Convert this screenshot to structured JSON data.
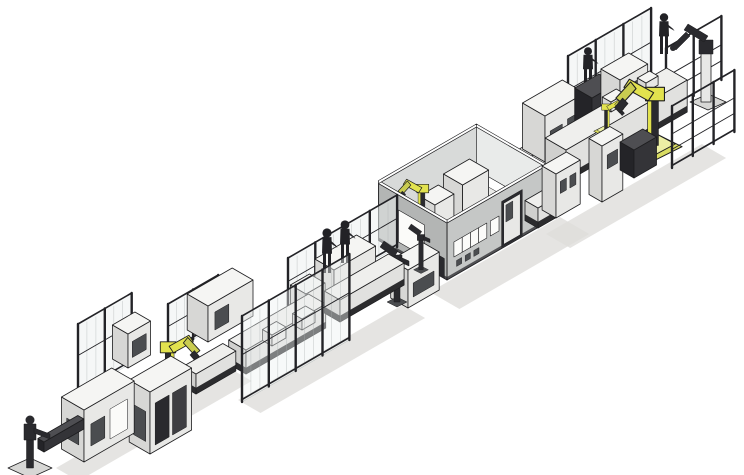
{
  "scene": {
    "alt": "Isometric CAD rendering of an automated assembly production line running diagonally from lower-left to upper-right, with safety fences, yellow industrial robots, operator figures, conveyors, machine cabinets and a central gray process enclosure",
    "width": 744,
    "height": 475,
    "components": [
      {
        "n": "ground-shadow-infeed",
        "t": "shadow",
        "o": [
          56,
          468
        ],
        "l": 200,
        "wd": 26
      },
      {
        "n": "ground-shadow-mid",
        "t": "shadow",
        "o": [
          238,
          400
        ],
        "l": 190,
        "wd": 26
      },
      {
        "n": "ground-shadow-enclosure",
        "t": "shadow",
        "o": [
          430,
          292
        ],
        "l": 150,
        "wd": 34
      },
      {
        "n": "ground-shadow-upper",
        "t": "shadow",
        "o": [
          546,
          234
        ],
        "l": 180,
        "wd": 28
      },
      {
        "n": "rear-storage-frame",
        "t": "frame",
        "o": [
          666,
          112
        ],
        "len": 64,
        "h": 64,
        "posts": 3
      },
      {
        "n": "rear-safety-fence-upper",
        "t": "fence",
        "o": [
          568,
          132
        ],
        "len": 96,
        "h": 76,
        "posts": 4
      },
      {
        "n": "operator-upper-line",
        "t": "worker",
        "o": [
          588,
          86
        ],
        "h": 40
      },
      {
        "n": "cabinet-upper-c",
        "t": "box",
        "o": [
          528,
          188
        ],
        "l": 20,
        "wd": 14,
        "h": 30,
        "c": "white"
      },
      {
        "n": "cabinet-upper-a",
        "t": "box",
        "o": [
          545,
          162
        ],
        "l": 46,
        "wd": 26,
        "h": 46,
        "c": "white",
        "panels": [
          [
            6,
            20,
            10,
            28,
            "md"
          ],
          [
            26,
            40,
            12,
            30,
            "md"
          ]
        ]
      },
      {
        "n": "cabinet-upper-dark",
        "t": "box",
        "o": [
          592,
          138
        ],
        "l": 28,
        "wd": 20,
        "h": 40,
        "c": "dark"
      },
      {
        "n": "cabinet-upper-b",
        "t": "box",
        "o": [
          620,
          124
        ],
        "l": 32,
        "wd": 22,
        "h": 44,
        "c": "white",
        "panels": [
          [
            6,
            26,
            12,
            34,
            "md"
          ]
        ]
      },
      {
        "n": "transfer-conveyor-upper",
        "t": "conv",
        "o": [
          566,
          182
        ],
        "len": 140,
        "wd": 24,
        "h": 32
      },
      {
        "n": "pallet-upper-1",
        "t": "box",
        "o": [
          611,
          112
        ],
        "l": 16,
        "wd": 10,
        "h": 10,
        "c": "white"
      },
      {
        "n": "pallet-upper-2",
        "t": "box",
        "o": [
          646,
          92
        ],
        "l": 14,
        "wd": 10,
        "h": 9,
        "c": "white"
      },
      {
        "n": "handling-robot-yellow-small",
        "t": "yrobot",
        "o": [
          606,
          130
        ],
        "s": 0.62,
        "flip": false
      },
      {
        "n": "gantry-robot-upper",
        "t": "yrobot",
        "o": [
          655,
          144
        ],
        "s": 1.35,
        "flip": true
      },
      {
        "n": "operator-upper-right",
        "t": "worker",
        "o": [
          664,
          54
        ],
        "h": 42
      },
      {
        "n": "pedestal-robot-end",
        "t": "drobot",
        "o": [
          706,
          100
        ],
        "v": "end"
      },
      {
        "n": "process-enclosure",
        "t": "room",
        "o": [
          447,
          280
        ],
        "l": 113,
        "wd": 79,
        "h": 57
      },
      {
        "n": "link-conveyor-room-exit",
        "t": "conv",
        "o": [
          538,
          228
        ],
        "len": 30,
        "wd": 15,
        "h": 20
      },
      {
        "n": "station-upper-a",
        "t": "box",
        "o": [
          556,
          218
        ],
        "l": 28,
        "wd": 16,
        "h": 44,
        "c": "white",
        "panels": [
          [
            5,
            12,
            22,
            34,
            "md"
          ],
          [
            16,
            23,
            22,
            34,
            "md"
          ]
        ]
      },
      {
        "n": "station-tower",
        "t": "box",
        "o": [
          602,
          202
        ],
        "l": 24,
        "wd": 15,
        "h": 56,
        "c": "white",
        "panels": [
          [
            6,
            18,
            30,
            44,
            "md"
          ]
        ]
      },
      {
        "n": "station-dark",
        "t": "box",
        "o": [
          634,
          178
        ],
        "l": 26,
        "wd": 16,
        "h": 28,
        "c": "dark"
      },
      {
        "n": "front-safety-frame-right",
        "t": "frame",
        "o": [
          672,
          168
        ],
        "len": 72,
        "h": 62,
        "posts": 4
      },
      {
        "n": "rear-fence-mid",
        "t": "fence",
        "o": [
          288,
          310
        ],
        "len": 126,
        "h": 52,
        "posts": 5
      },
      {
        "n": "workstation-table-a",
        "t": "box",
        "o": [
          334,
          304
        ],
        "l": 48,
        "wd": 22,
        "h": 34,
        "c": "white"
      },
      {
        "n": "workstation-table-b",
        "t": "box",
        "o": [
          306,
          320
        ],
        "l": 22,
        "wd": 18,
        "h": 26,
        "c": "white"
      },
      {
        "n": "operator-mid-a",
        "t": "worker",
        "o": [
          327,
          273
        ],
        "h": 46
      },
      {
        "n": "operator-mid-b",
        "t": "worker",
        "o": [
          345,
          263
        ],
        "h": 44
      },
      {
        "n": "pre-enclosure-station",
        "t": "box",
        "o": [
          408,
          308
        ],
        "l": 36,
        "wd": 20,
        "h": 38,
        "c": "white",
        "panels": [
          [
            6,
            30,
            8,
            22,
            "md"
          ]
        ]
      },
      {
        "n": "handling-robot-mid",
        "t": "drobot",
        "o": [
          397,
          301
        ],
        "v": "post"
      },
      {
        "n": "handling-robot-mid-b",
        "t": "drobot",
        "o": [
          421,
          269
        ],
        "v": "post-s"
      },
      {
        "n": "rear-fence-left-mid",
        "t": "fence",
        "o": [
          168,
          354
        ],
        "len": 58,
        "h": 50,
        "posts": 3
      },
      {
        "n": "buffer-cabinet-mid",
        "t": "box",
        "o": [
          208,
          342
        ],
        "l": 52,
        "wd": 24,
        "h": 36,
        "c": "white",
        "panels": [
          [
            8,
            24,
            8,
            26,
            "md"
          ]
        ]
      },
      {
        "n": "line-conveyor-mid-a",
        "t": "conv",
        "o": [
          246,
          374
        ],
        "len": 92,
        "wd": 20,
        "h": 24
      },
      {
        "n": "line-conveyor-mid-b",
        "t": "conv",
        "o": [
          340,
          322
        ],
        "len": 74,
        "wd": 18,
        "h": 22
      },
      {
        "n": "pallet-mid-1",
        "t": "box",
        "o": [
          272,
          346
        ],
        "l": 16,
        "wd": 11,
        "h": 11,
        "c": "white"
      },
      {
        "n": "pallet-mid-2",
        "t": "box",
        "o": [
          302,
          330
        ],
        "l": 15,
        "wd": 11,
        "h": 11,
        "c": "white"
      },
      {
        "n": "front-safety-fence-mid",
        "t": "fence",
        "o": [
          242,
          402
        ],
        "len": 124,
        "h": 86,
        "posts": 5,
        "op": 0.42
      },
      {
        "n": "rear-fence-cell",
        "t": "fence",
        "o": [
          78,
          394
        ],
        "len": 62,
        "h": 70,
        "posts": 3
      },
      {
        "n": "cell-cabinet",
        "t": "box",
        "o": [
          128,
          368
        ],
        "l": 26,
        "wd": 18,
        "h": 34,
        "c": "white",
        "panels": [
          [
            5,
            21,
            8,
            24,
            "md"
          ]
        ]
      },
      {
        "n": "cell-robot",
        "t": "yrobot",
        "o": [
          168,
          388
        ],
        "s": 1.1,
        "flip": false
      },
      {
        "n": "cell-conveyor",
        "t": "conv",
        "o": [
          196,
          394
        ],
        "len": 46,
        "wd": 15,
        "h": 20
      },
      {
        "n": "main-cabinet-dark-doors",
        "t": "box",
        "o": [
          150,
          454
        ],
        "l": 48,
        "wd": 24,
        "h": 62,
        "c": "white",
        "panels": [
          [
            6,
            22,
            6,
            48,
            "dk"
          ],
          [
            26,
            42,
            6,
            48,
            "dk2"
          ]
        ],
        "wpanels": [
          [
            5,
            19,
            10,
            40,
            "md"
          ]
        ]
      },
      {
        "n": "main-cabinet-left",
        "t": "box",
        "o": [
          84,
          462
        ],
        "l": 58,
        "wd": 26,
        "h": 52,
        "c": "white",
        "panels": [
          [
            8,
            24,
            12,
            34,
            "md"
          ],
          [
            30,
            50,
            8,
            38,
            "lt"
          ]
        ],
        "wpanels": [
          [
            6,
            20,
            14,
            34,
            "md"
          ]
        ]
      },
      {
        "n": "infeed-beam",
        "t": "box",
        "o": [
          44,
          452
        ],
        "l": 46,
        "wd": 7,
        "h": 10,
        "c": "dark"
      },
      {
        "n": "pedestal-robot-start",
        "t": "drobot",
        "o": [
          30,
          466
        ],
        "v": "start"
      }
    ]
  },
  "palette": {
    "background": "#ffffff",
    "outline": "#1d1d1f",
    "machine_top": "#f5f5f3",
    "machine_side": "#e8e8e6",
    "machine_end": "#d7d7d5",
    "dark_top": "#4e4e52",
    "dark_side": "#343438",
    "dark_end": "#242428",
    "conveyor_top": "#efefed",
    "conveyor_side": "#e1e1df",
    "conveyor_end": "#d0d0ce",
    "undercarriage": "#2c2c2e",
    "enclosure_side": "#c5c7c6",
    "enclosure_end": "#b3b5b4",
    "enclosure_inner": "#d8dad9",
    "enclosure_inner2": "#e9ebea",
    "enclosure_floor": "#ebebe9",
    "fence_glass": "#edf1f1",
    "fence_post": "#232327",
    "robot_yellow": "#e2e24e",
    "robot_yellow_dark": "#c9cc50",
    "robot_yellow_pale": "#ecefa4",
    "robot_yellow_slab": "#d9dc62",
    "panel_dark": "#2a2a2e",
    "panel_dark2": "#3e3e42",
    "panel_mid": "#4b4d50",
    "panel_light": "#fbfbf9",
    "worker": "#222226",
    "shadow": "#dedddb",
    "white": "#ffffff"
  }
}
